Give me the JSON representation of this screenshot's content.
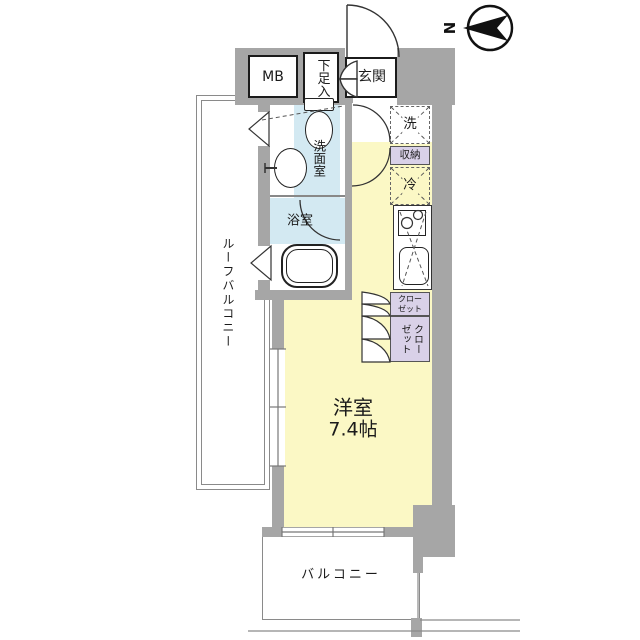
{
  "compass": {
    "label": "N"
  },
  "rooms": {
    "meter_box": {
      "label": "MB"
    },
    "shoe_storage": {
      "label": "下足入"
    },
    "entrance": {
      "label": "玄関"
    },
    "washing_machine": {
      "label": "洗"
    },
    "storage": {
      "label": "収納"
    },
    "refrigerator": {
      "label": "冷"
    },
    "washroom": {
      "label": "洗面室"
    },
    "bathroom": {
      "label": "浴室"
    },
    "closet_upper": {
      "label_line1": "クロー",
      "label_line2": "ゼット"
    },
    "closet_lower": {
      "label_col_right": "クロー",
      "label_col_left": "ゼット"
    },
    "western_room": {
      "label": "洋室",
      "size": "7.4帖"
    },
    "roof_balcony": {
      "label": "ルーフバルコニー"
    },
    "balcony": {
      "label": "バルコニー"
    }
  },
  "colors": {
    "wall": "#a6a6a6",
    "room_floor": "#fbf8c5",
    "wet_area": "#d3e9f2",
    "closet": "#d9d1e8",
    "line": "#333333"
  }
}
